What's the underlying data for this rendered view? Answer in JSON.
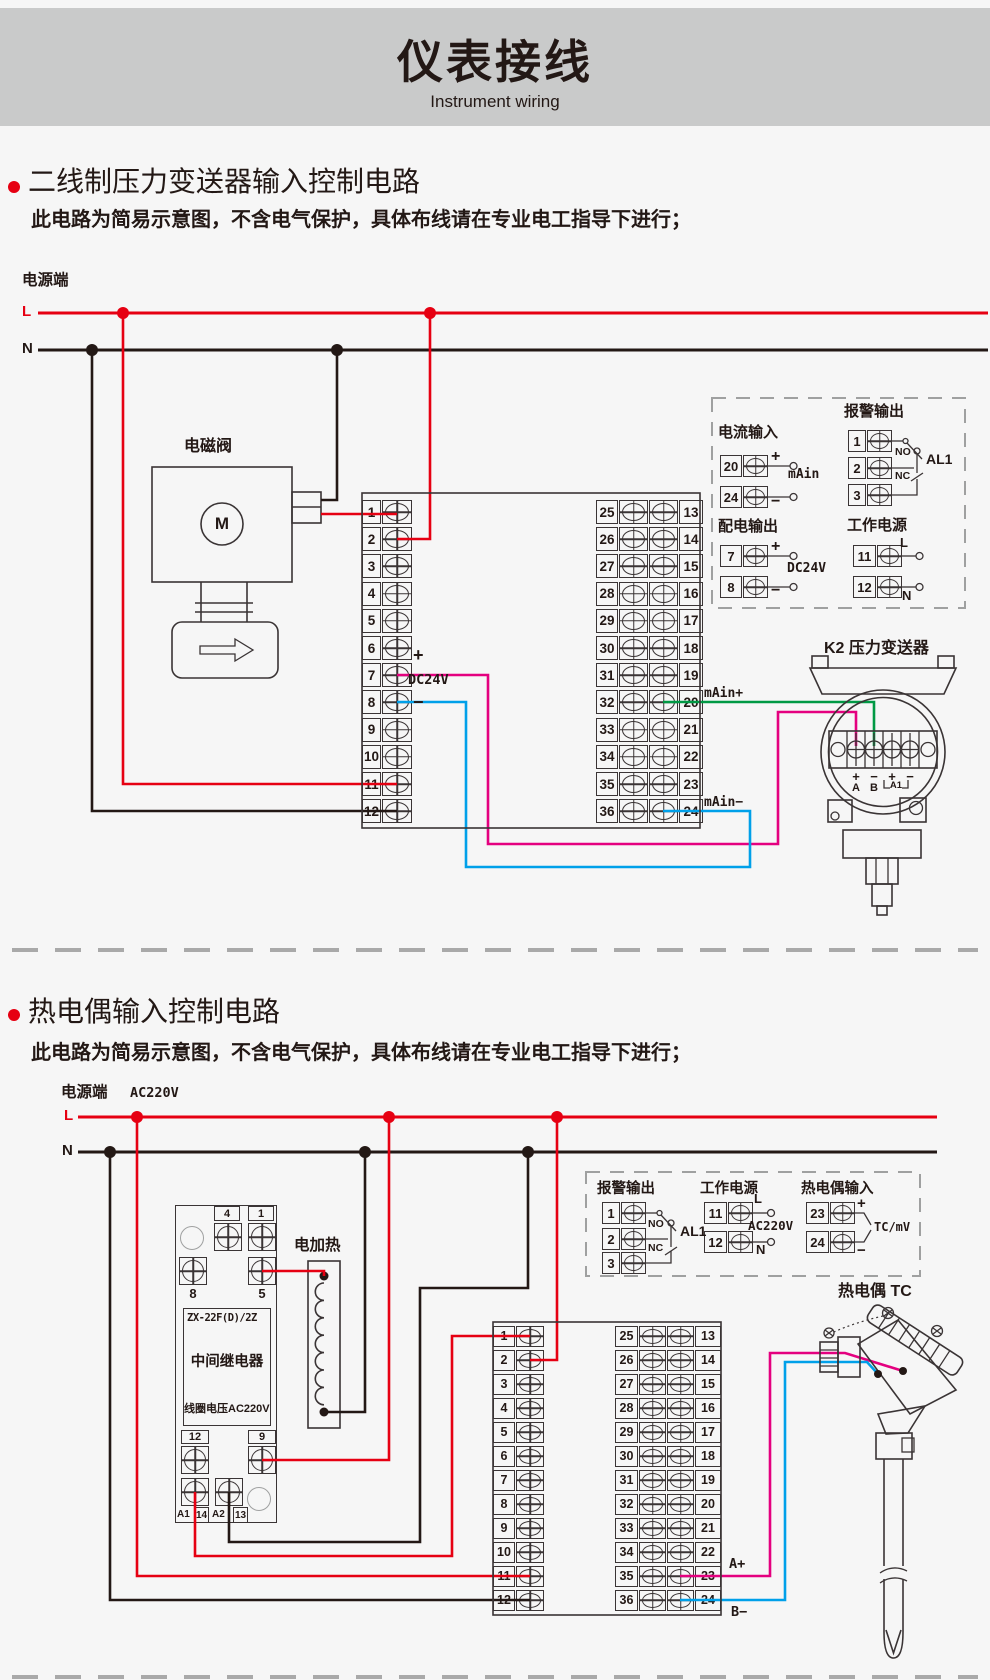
{
  "colors": {
    "red": "#e60012",
    "wire_black": "#231815",
    "green": "#009944",
    "magenta": "#e4007f",
    "blue": "#00a0e9",
    "line": "#3a3435",
    "gray": "#9fa0a0",
    "header_bg": "#c9caca",
    "page_bg": "#f6f6f6",
    "text": "#231815"
  },
  "header": {
    "title": "仪表接线",
    "subtitle": "Instrument wiring"
  },
  "terminals": {
    "left": [
      "1",
      "2",
      "3",
      "4",
      "5",
      "6",
      "7",
      "8",
      "9",
      "10",
      "11",
      "12"
    ],
    "mid": [
      "25",
      "26",
      "27",
      "28",
      "29",
      "30",
      "31",
      "32",
      "33",
      "34",
      "35",
      "36"
    ],
    "right": [
      "13",
      "14",
      "15",
      "16",
      "17",
      "18",
      "19",
      "20",
      "21",
      "22",
      "23",
      "24"
    ]
  },
  "section1": {
    "title": "二线制压力变送器输入控制电路",
    "note": "此电路为简易示意图，不含电气保护，具体布线请在专业电工指导下进行；",
    "power_label": "电源端",
    "l": "L",
    "n": "N",
    "solenoid": {
      "label": "电磁阀",
      "motor": "M"
    },
    "instrument": {
      "plus": "+",
      "dc24v": "DC24V",
      "minus": "−",
      "main_plus": "mAin+",
      "main_minus": "mAin−"
    },
    "panel": {
      "current_input": {
        "title": "电流输入",
        "t1": "20",
        "t1_sign": "+",
        "t2": "24",
        "t2_sign": "−",
        "label": "mAin"
      },
      "alarm_output": {
        "title": "报警输出",
        "t1": "1",
        "t2": "2",
        "t3": "3",
        "no": "NO",
        "nc": "NC",
        "al": "AL1"
      },
      "dist_output": {
        "title": "配电输出",
        "t1": "7",
        "t1_sign": "+",
        "t2": "8",
        "t2_sign": "−",
        "label": "DC24V"
      },
      "work_power": {
        "title": "工作电源",
        "t1": "11",
        "t1_sign": "L",
        "t2": "12",
        "t2_sign": "N"
      }
    },
    "transmitter": {
      "label": "K2 压力变送器",
      "signs": [
        "+",
        "−",
        "+",
        "−"
      ],
      "a": "A",
      "b": "B",
      "a1": "A1"
    }
  },
  "section2": {
    "title": "热电偶输入控制电路",
    "note": "此电路为简易示意图，不含电气保护，具体布线请在专业电工指导下进行；",
    "power_label": "电源端",
    "voltage": "AC220V",
    "l": "L",
    "n": "N",
    "relay": {
      "top1": "4",
      "top2": "1",
      "mid1": "8",
      "mid2": "5",
      "model": "ZX-22F(D)/2Z",
      "name": "中间继电器",
      "coil": "线圈电压AC220V",
      "bot1": "12",
      "bot2": "9",
      "a1": "A1",
      "n14": "14",
      "a2": "A2",
      "n13": "13"
    },
    "heater": {
      "label": "电加热"
    },
    "instrument": {
      "a_plus": "A+",
      "b_minus": "B−"
    },
    "panel": {
      "alarm_output": {
        "title": "报警输出",
        "t1": "1",
        "t2": "2",
        "t3": "3",
        "no": "NO",
        "nc": "NC",
        "al": "AL1"
      },
      "work_power": {
        "title": "工作电源",
        "t1": "11",
        "t1_sign": "L",
        "t2": "12",
        "t2_sign": "N",
        "label": "AC220V"
      },
      "tc_input": {
        "title": "热电偶输入",
        "t1": "23",
        "t1_sign": "+",
        "t2": "24",
        "t2_sign": "−",
        "label": "TC/mV"
      }
    },
    "thermocouple": {
      "label": "热电偶 TC"
    }
  }
}
